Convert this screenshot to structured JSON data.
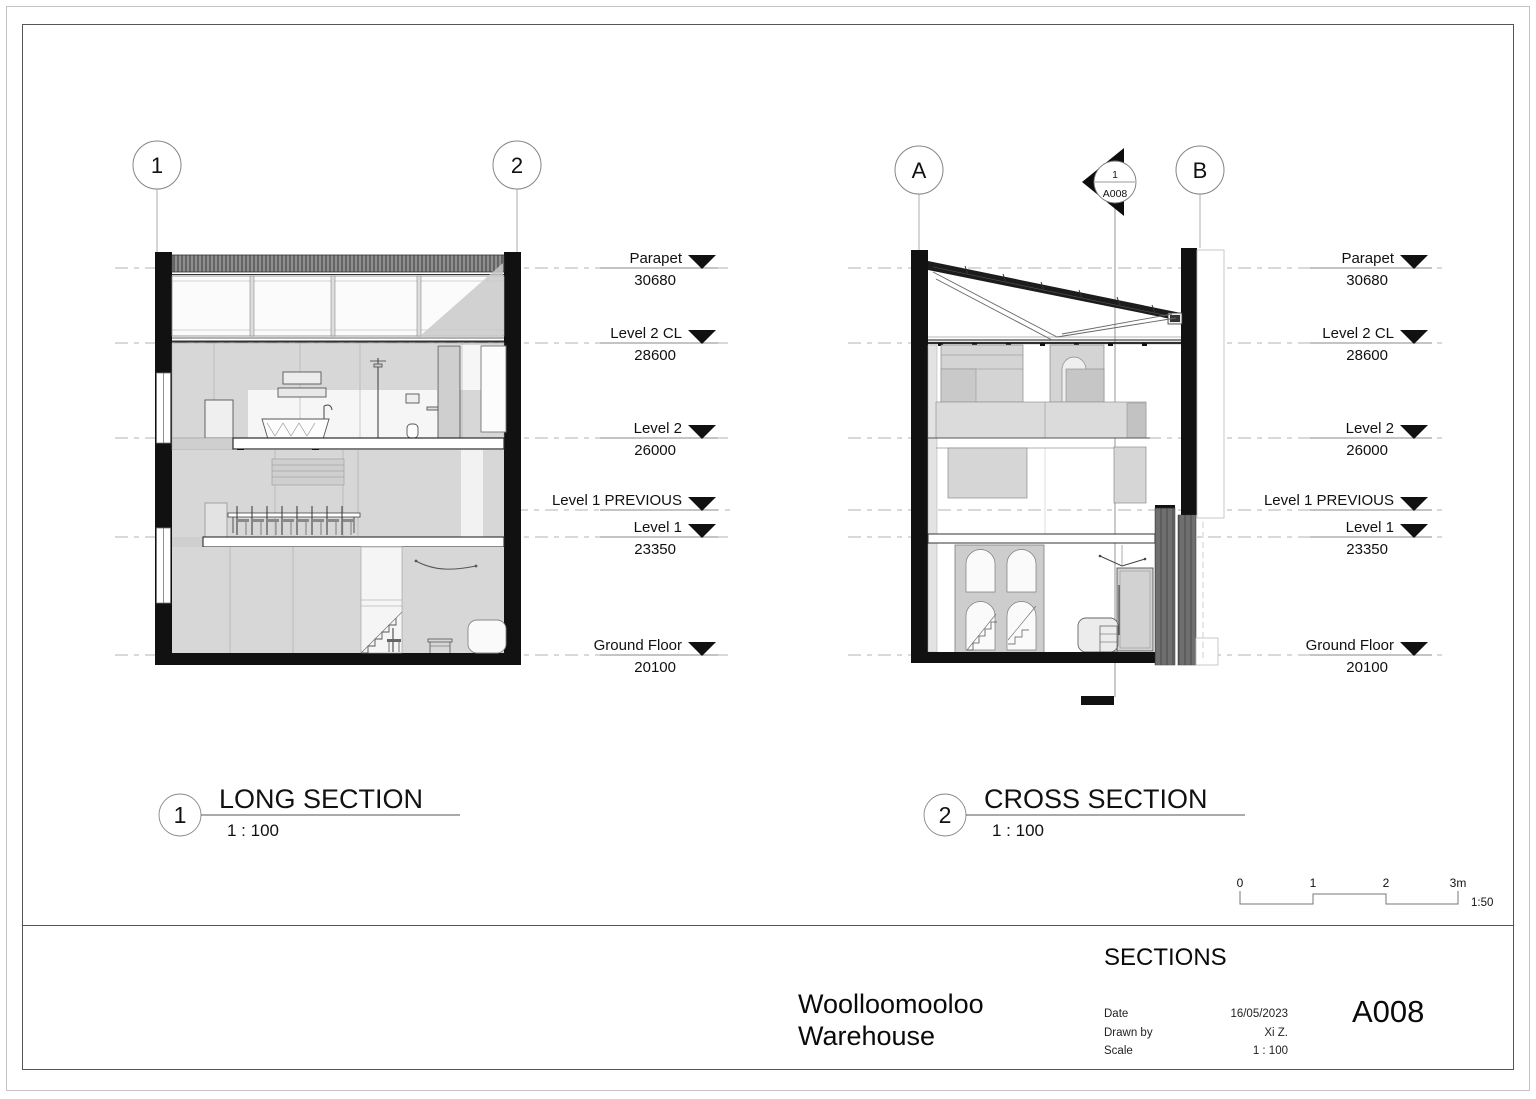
{
  "sheet": {
    "title_block": {
      "sheet_title": "SECTIONS",
      "project_name_line1": "Woolloomooloo",
      "project_name_line2": "Warehouse",
      "fields": [
        {
          "label": "Date",
          "value": "16/05/2023"
        },
        {
          "label": "Drawn by",
          "value": "Xi Z."
        },
        {
          "label": "Scale",
          "value": "1 : 100"
        }
      ],
      "sheet_number": "A008"
    },
    "scale_bar": {
      "ticks": [
        "0",
        "1",
        "2",
        "3m"
      ],
      "ratio": "1:50"
    }
  },
  "views": [
    {
      "number": "1",
      "title": "LONG SECTION",
      "scale": "1 : 100",
      "grid_bubbles": [
        "1",
        "2"
      ]
    },
    {
      "number": "2",
      "title": "CROSS SECTION",
      "scale": "1 : 100",
      "grid_bubbles": [
        "A",
        "B"
      ],
      "section_marker": {
        "detail_number": "1",
        "sheet": "A008"
      }
    }
  ],
  "levels": [
    {
      "name": "Parapet",
      "elevation": "30680"
    },
    {
      "name": "Level 2 CL",
      "elevation": "28600"
    },
    {
      "name": "Level 2",
      "elevation": "26000"
    },
    {
      "name": "Level 1 PREVIOUS",
      "elevation": ""
    },
    {
      "name": "Level 1",
      "elevation": "23350"
    },
    {
      "name": "Ground Floor",
      "elevation": "20100"
    }
  ]
}
